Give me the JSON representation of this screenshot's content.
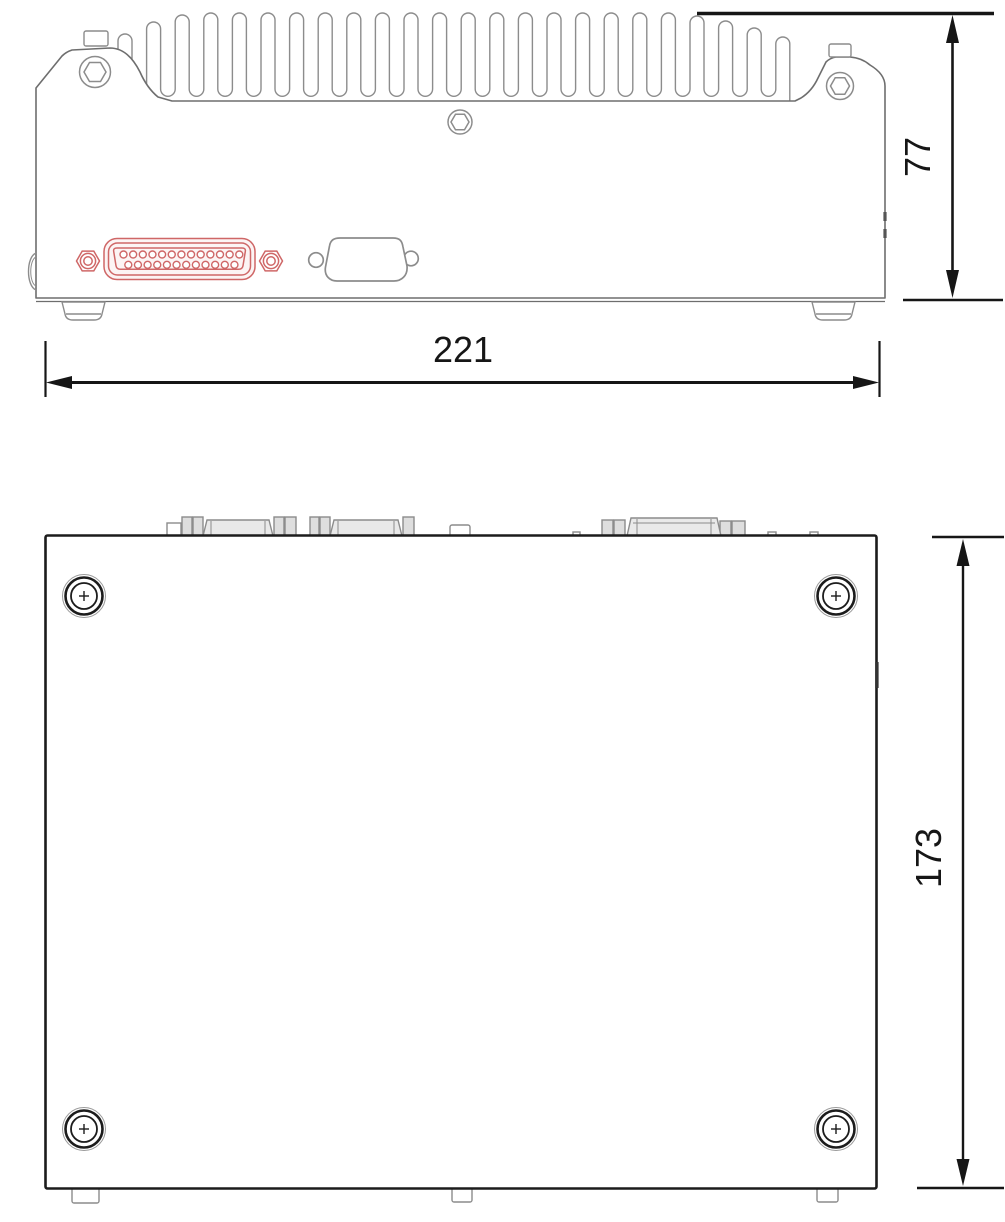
{
  "drawing": {
    "dimensions": {
      "width_label": "221",
      "height_label": "77",
      "depth_label": "173"
    },
    "heatsink": {
      "fin_count": 24
    },
    "connectors": {
      "db25": {
        "pins_top_row": 13,
        "pins_bottom_row": 12,
        "highlight_color": "#cf6767",
        "highlight_fill": "#fcf4f4"
      }
    },
    "colors": {
      "outline": "#8c8c8c",
      "dark_line": "#1c1c1c",
      "dimension": "#161616",
      "connector_fill": "#e9e9e9"
    }
  }
}
